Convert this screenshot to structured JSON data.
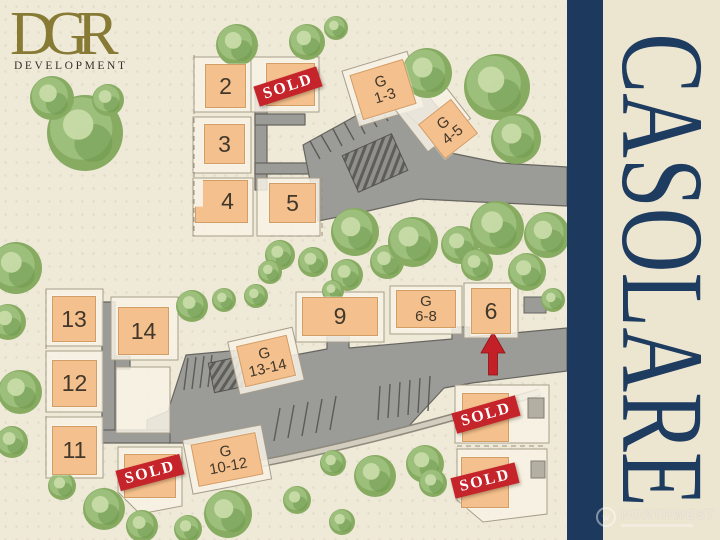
{
  "logo": {
    "brand": "DGR",
    "sub": "DEVELOPMENT"
  },
  "panel": {
    "title": "CASOLARE"
  },
  "watermark": {
    "name": "NORTHWEST",
    "monogram": "w"
  },
  "map": {
    "sold_label": "SOLD",
    "colors": {
      "map_bg": "#efe9d8",
      "panel_bg": "#ece5d0",
      "navy": "#1d3a5e",
      "road": "#9b9b98",
      "road_edge": "#66655f",
      "lot_fill": "#f4c08d",
      "sold_red": "#c5242a",
      "logo_gold": "#877a35",
      "tree_base": "#86ab61",
      "tree_mid": "#9dbf7c",
      "tree_dark": "#6f9b50",
      "tree_light": "#c7dba6"
    },
    "lots": [
      {
        "name": "lot-2",
        "label": "2",
        "x": 205,
        "y": 64,
        "w": 41,
        "h": 44
      },
      {
        "name": "lot-sold-a",
        "x": 266,
        "y": 63,
        "w": 49,
        "h": 43,
        "sold": {
          "cx": 288,
          "cy": 87,
          "rot": -18
        }
      },
      {
        "name": "lot-3",
        "label": "3",
        "x": 204,
        "y": 124,
        "w": 41,
        "h": 40
      },
      {
        "name": "lot-4",
        "label": "4",
        "x": 195,
        "y": 180,
        "w": 53,
        "h": 43,
        "notch": true
      },
      {
        "name": "lot-5",
        "label": "5",
        "x": 269,
        "y": 183,
        "w": 47,
        "h": 40
      },
      {
        "name": "garage-1-3",
        "label": "G",
        "label2": "1-3",
        "x": 355,
        "y": 66,
        "w": 56,
        "h": 47,
        "rot": -17
      },
      {
        "name": "garage-4-5",
        "label": "G",
        "label2": "4-5",
        "x": 427,
        "y": 107,
        "w": 42,
        "h": 44,
        "rot": -38
      },
      {
        "name": "lot-13",
        "label": "13",
        "x": 52,
        "y": 296,
        "w": 44,
        "h": 46
      },
      {
        "name": "lot-14",
        "label": "14",
        "x": 118,
        "y": 307,
        "w": 51,
        "h": 48
      },
      {
        "name": "lot-12",
        "label": "12",
        "x": 52,
        "y": 360,
        "w": 45,
        "h": 47
      },
      {
        "name": "lot-11",
        "label": "11",
        "x": 52,
        "y": 426,
        "w": 45,
        "h": 49
      },
      {
        "name": "lot-9",
        "label": "9",
        "x": 302,
        "y": 297,
        "w": 76,
        "h": 39
      },
      {
        "name": "garage-6-8",
        "label": "G",
        "label2": "6-8",
        "x": 396,
        "y": 290,
        "w": 60,
        "h": 38
      },
      {
        "name": "lot-6",
        "label": "6",
        "x": 471,
        "y": 288,
        "w": 40,
        "h": 46
      },
      {
        "name": "garage-13-14",
        "label": "G",
        "label2": "13-14",
        "x": 240,
        "y": 340,
        "w": 52,
        "h": 42,
        "rot": -13
      },
      {
        "name": "garage-10-12",
        "label": "G",
        "label2": "10-12",
        "x": 194,
        "y": 438,
        "w": 66,
        "h": 43,
        "rot": -11
      },
      {
        "name": "lot-sold-b",
        "x": 124,
        "y": 454,
        "w": 52,
        "h": 44,
        "sold": {
          "cx": 150,
          "cy": 473,
          "rot": -15
        }
      },
      {
        "name": "lot-sold-c",
        "x": 462,
        "y": 393,
        "w": 47,
        "h": 49,
        "sold": {
          "cx": 486,
          "cy": 415,
          "rot": -16
        }
      },
      {
        "name": "lot-sold-d",
        "x": 461,
        "y": 457,
        "w": 48,
        "h": 51,
        "sold": {
          "cx": 485,
          "cy": 481,
          "rot": -14
        }
      }
    ],
    "trees": [
      [
        85,
        133,
        38
      ],
      [
        52,
        98,
        22
      ],
      [
        108,
        100,
        16
      ],
      [
        237,
        45,
        21
      ],
      [
        307,
        42,
        18
      ],
      [
        336,
        28,
        12
      ],
      [
        427,
        73,
        25
      ],
      [
        497,
        87,
        33
      ],
      [
        516,
        139,
        25
      ],
      [
        280,
        255,
        15
      ],
      [
        313,
        262,
        15
      ],
      [
        347,
        275,
        16
      ],
      [
        355,
        232,
        24
      ],
      [
        387,
        262,
        17
      ],
      [
        413,
        242,
        25
      ],
      [
        460,
        245,
        19
      ],
      [
        477,
        265,
        16
      ],
      [
        497,
        228,
        27
      ],
      [
        527,
        272,
        19
      ],
      [
        547,
        235,
        23
      ],
      [
        333,
        291,
        11
      ],
      [
        270,
        272,
        12
      ],
      [
        553,
        300,
        12
      ],
      [
        192,
        306,
        16
      ],
      [
        224,
        300,
        12
      ],
      [
        256,
        296,
        12
      ],
      [
        16,
        268,
        26
      ],
      [
        8,
        322,
        18
      ],
      [
        20,
        392,
        22
      ],
      [
        12,
        442,
        16
      ],
      [
        62,
        486,
        14
      ],
      [
        104,
        509,
        21
      ],
      [
        142,
        526,
        16
      ],
      [
        188,
        529,
        14
      ],
      [
        228,
        514,
        24
      ],
      [
        297,
        500,
        14
      ],
      [
        333,
        463,
        13
      ],
      [
        375,
        476,
        21
      ],
      [
        425,
        464,
        19
      ],
      [
        433,
        483,
        14
      ],
      [
        342,
        522,
        13
      ]
    ]
  }
}
